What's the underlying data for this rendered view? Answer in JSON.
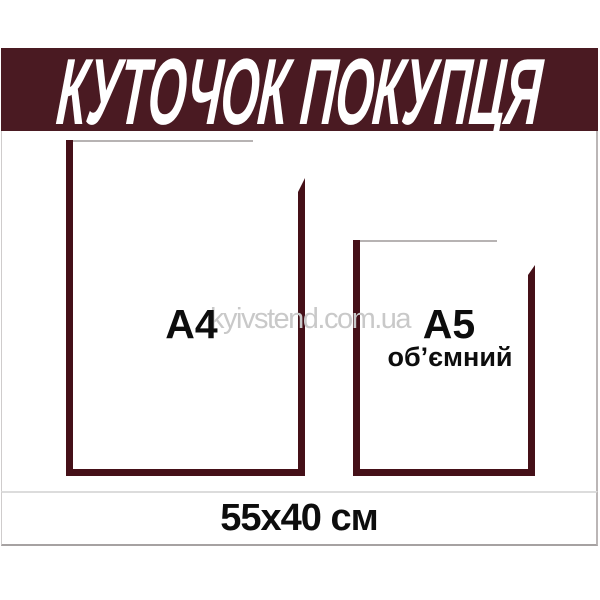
{
  "product_stand": {
    "header": {
      "title": "КУТОЧОК ПОКУПЦЯ",
      "band_color": "#4a1a22",
      "text_color": "#ffffff"
    },
    "pockets": {
      "a4": {
        "label": "А4"
      },
      "a5": {
        "label": "А5",
        "sublabel": "об’ємний"
      }
    },
    "footer": {
      "dimensions_label": "55x40 см"
    },
    "watermark": {
      "text": "kyivstend.com.ua",
      "color": "#c9c9c9"
    },
    "colors": {
      "pocket_border": "#451018",
      "pocket_top_line": "#b7b3b3",
      "separator_line_light": "#dcdcdc",
      "separator_line_dark": "#a6a2a2",
      "label_text": "#0d0d0d"
    }
  }
}
